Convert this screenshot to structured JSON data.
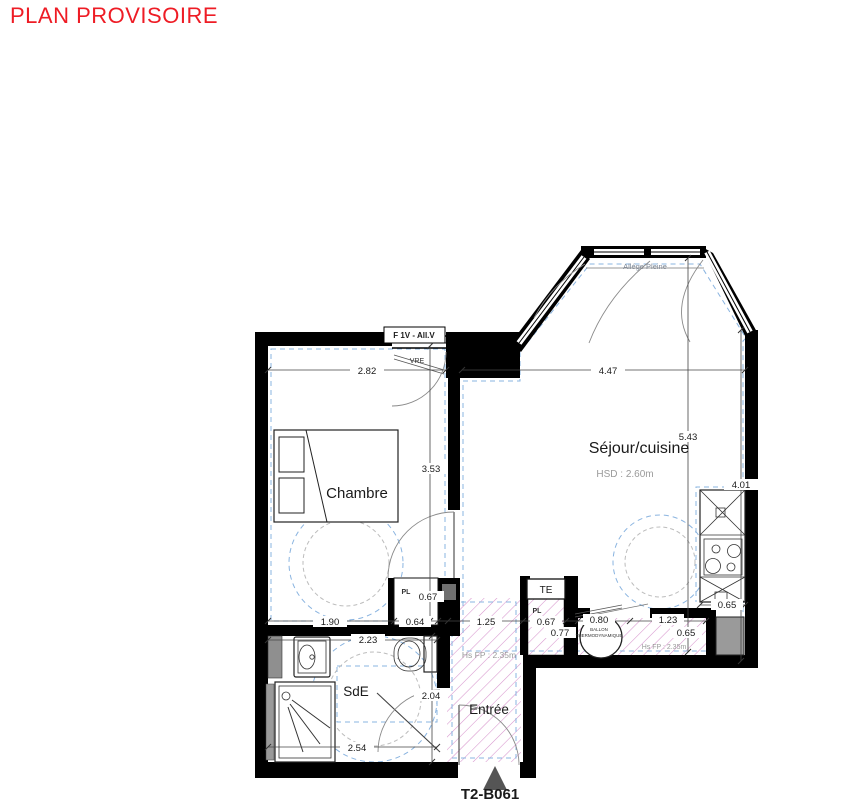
{
  "title": "PLAN PROVISOIRE",
  "unit": {
    "code": "T2-B061"
  },
  "rooms": {
    "chambre": {
      "name": "Chambre"
    },
    "sejour": {
      "name": "Séjour/cuisine",
      "ceiling": "HSD : 2.60m"
    },
    "sde": {
      "name": "SdE"
    },
    "entree": {
      "name": "Entrée",
      "ceiling": "Hs FP : 2.35m"
    }
  },
  "annotations": {
    "window": "F 1V - All.V",
    "shutter": "VRE",
    "spandrel": "Allége Pleine",
    "electrical_panel": "TE",
    "closet": "PL",
    "water_heater_line1": "BALLON",
    "water_heater_line2": "THERMODYNAMIQUE",
    "ceiling_drop": "Hs FP : 2.35m"
  },
  "dimensions": {
    "chambre_width": "2.82",
    "sejour_width": "4.47",
    "sejour_depth": "5.43",
    "chambre_depth": "3.53",
    "kitchen_wall": "4.01",
    "kitchen_counter": "0.65",
    "chambre_bottom": "1.90",
    "closet1_width": "0.64",
    "closet1_depth": "0.67",
    "hall_width": "1.25",
    "closet2_width": "0.67",
    "closet2_depth": "0.77",
    "water_heater_width": "0.80",
    "storage_width": "1.23",
    "storage_depth": "0.65",
    "sde_width": "2.23",
    "sde_depth": "2.04",
    "sde_bottom": "2.54"
  },
  "colors": {
    "title": "#ee1c25",
    "wall": "#000000",
    "accessibility_circle": "#8ab4e0",
    "hatch": "#d795cd"
  }
}
